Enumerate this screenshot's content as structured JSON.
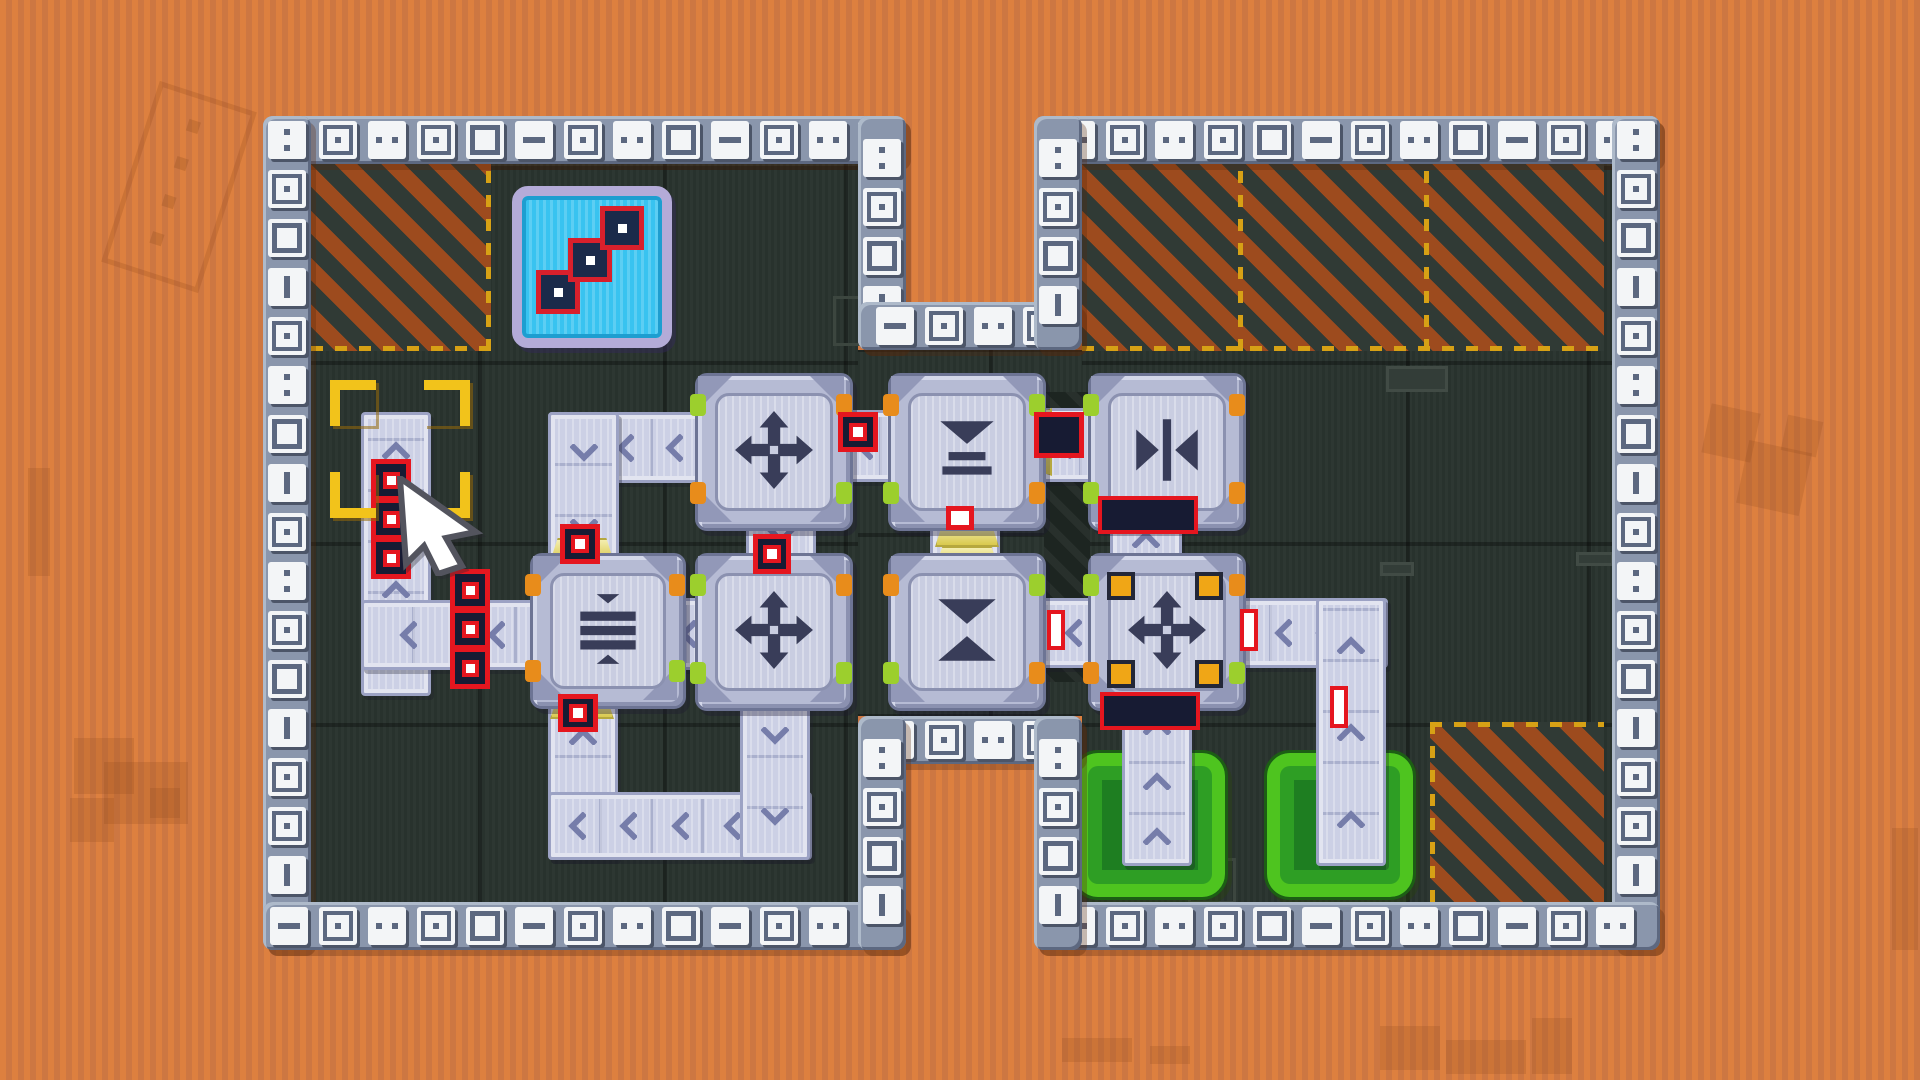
{
  "game": {
    "title": "conveyor-factory-puzzle-board",
    "colors": {
      "background_orange": "#dc7e3d",
      "floor_dark": "#28322d",
      "wall_band": "#8a96ac",
      "wall_tile": "#f3f5f7",
      "hazard_orange": "#9d4b1e",
      "hazard_dark": "#303a35",
      "hazard_dash_yellow": "#d7a115",
      "belt_lavender": "#ccd0e5",
      "machine_lavender": "#b6bbd4",
      "icon_navy": "#393d59",
      "item_red": "#e5161f",
      "item_navy": "#171b33",
      "goal_green_bright": "#4ec41f",
      "goal_green_dark": "#1e7e21",
      "sign_cyan": "#38c3f0",
      "sign_frame": "#b4abd8",
      "selection_yellow": "#f2c31b",
      "nub_green": "#9ccf2d",
      "nub_orange": "#e88c1b"
    },
    "scene": {
      "watermarks": [
        {
          "kind": "ruler-outline",
          "x": 128,
          "y": 92,
          "w": 92,
          "h": 180,
          "rot": 18
        },
        {
          "kind": "square",
          "x": 74,
          "y": 738,
          "w": 60,
          "h": 56,
          "rot": 0
        },
        {
          "kind": "square",
          "x": 104,
          "y": 762,
          "w": 84,
          "h": 62,
          "rot": 0
        },
        {
          "kind": "square",
          "x": 70,
          "y": 798,
          "w": 44,
          "h": 44,
          "rot": 0
        },
        {
          "kind": "square",
          "x": 150,
          "y": 788,
          "w": 30,
          "h": 30,
          "rot": 0
        },
        {
          "kind": "bar",
          "x": 28,
          "y": 468,
          "w": 22,
          "h": 108,
          "rot": 0
        },
        {
          "kind": "square",
          "x": 1706,
          "y": 408,
          "w": 50,
          "h": 50,
          "rot": 12
        },
        {
          "kind": "square",
          "x": 1742,
          "y": 446,
          "w": 64,
          "h": 64,
          "rot": 12
        },
        {
          "kind": "square",
          "x": 1784,
          "y": 418,
          "w": 36,
          "h": 36,
          "rot": 12
        },
        {
          "kind": "bar",
          "x": 1892,
          "y": 828,
          "w": 26,
          "h": 122,
          "rot": 0
        },
        {
          "kind": "square",
          "x": 1062,
          "y": 1038,
          "w": 70,
          "h": 24,
          "rot": 0
        },
        {
          "kind": "square",
          "x": 1150,
          "y": 1046,
          "w": 40,
          "h": 18,
          "rot": 0
        },
        {
          "kind": "square",
          "x": 1380,
          "y": 1026,
          "w": 60,
          "h": 44,
          "rot": 0
        },
        {
          "kind": "square",
          "x": 1446,
          "y": 1040,
          "w": 80,
          "h": 34,
          "rot": 0
        },
        {
          "kind": "square",
          "x": 1532,
          "y": 1018,
          "w": 40,
          "h": 56,
          "rot": 0
        }
      ],
      "floors": [
        {
          "x": 311,
          "y": 164,
          "w": 547,
          "h": 738,
          "grid_phase_x": 175,
          "grid_phase_y": 183
        },
        {
          "x": 1082,
          "y": 164,
          "w": 530,
          "h": 738,
          "grid_phase_x": 147,
          "grid_phase_y": 183
        },
        {
          "x": 858,
          "y": 350,
          "w": 224,
          "h": 366,
          "grid_phase_x": 178,
          "grid_phase_y": 179
        }
      ],
      "hazards": [
        {
          "x": 311,
          "y": 164,
          "w": 180,
          "h": 187,
          "dash": [
            "right",
            "bottom"
          ]
        },
        {
          "x": 1082,
          "y": 164,
          "w": 522,
          "h": 187,
          "dash": [
            "bottom"
          ]
        },
        {
          "x": 1430,
          "y": 722,
          "w": 174,
          "h": 180,
          "dash": [
            "top",
            "left"
          ]
        }
      ],
      "hazard_separators": [
        {
          "x": 1238,
          "y": 164,
          "h": 187
        },
        {
          "x": 1424,
          "y": 164,
          "h": 187
        }
      ],
      "floor_marks": [
        {
          "type": "slot",
          "x": 1386,
          "y": 366,
          "w": 62,
          "h": 26
        },
        {
          "type": "slot",
          "x": 1380,
          "y": 562,
          "w": 34,
          "h": 14
        },
        {
          "type": "slot",
          "x": 1576,
          "y": 552,
          "w": 38,
          "h": 14
        },
        {
          "type": "outline",
          "x": 833,
          "y": 296,
          "w": 44,
          "h": 44
        },
        {
          "type": "outline",
          "x": 1188,
          "y": 858,
          "w": 42,
          "h": 40
        }
      ],
      "duct": {
        "x": 1044,
        "y": 392,
        "w": 46,
        "h": 290
      },
      "walls": [
        {
          "x": 263,
          "y": 116,
          "len": 643,
          "dir": "h"
        },
        {
          "x": 263,
          "y": 116,
          "len": 834,
          "dir": "v"
        },
        {
          "x": 263,
          "y": 902,
          "len": 643,
          "dir": "h"
        },
        {
          "x": 858,
          "y": 116,
          "len": 234,
          "dir": "v"
        },
        {
          "x": 858,
          "y": 302,
          "len": 224,
          "dir": "h"
        },
        {
          "x": 858,
          "y": 716,
          "len": 224,
          "dir": "h"
        },
        {
          "x": 858,
          "y": 716,
          "len": 234,
          "dir": "v"
        },
        {
          "x": 1034,
          "y": 116,
          "len": 626,
          "dir": "h"
        },
        {
          "x": 1612,
          "y": 116,
          "len": 834,
          "dir": "v"
        },
        {
          "x": 1034,
          "y": 902,
          "len": 626,
          "dir": "h"
        },
        {
          "x": 1034,
          "y": 116,
          "len": 234,
          "dir": "v"
        },
        {
          "x": 1034,
          "y": 716,
          "len": 234,
          "dir": "v"
        }
      ],
      "wall_glyph_cycle": [
        "corner",
        "dash",
        "boxdot",
        "dots",
        "boxdot",
        "box",
        "dash",
        "boxdot",
        "dots",
        "box",
        "dash",
        "boxdot",
        "dots",
        "boxdot",
        "box",
        "dash",
        "boxdot"
      ],
      "goal_pads": [
        {
          "x": 1072,
          "y": 750,
          "w": 150,
          "h": 144
        },
        {
          "x": 1264,
          "y": 750,
          "w": 146,
          "h": 144
        }
      ],
      "sign": {
        "x": 512,
        "y": 186,
        "w": 140,
        "h": 142,
        "items": [
          {
            "dx": 14,
            "dy": 74
          },
          {
            "dx": 46,
            "dy": 42
          },
          {
            "dx": 78,
            "dy": 10
          }
        ]
      },
      "belts": [
        {
          "x": 361,
          "y": 412,
          "w": 64,
          "h": 278,
          "dir": "up",
          "chev": 4
        },
        {
          "x": 361,
          "y": 600,
          "w": 176,
          "h": 64,
          "dir": "left",
          "chev": 2
        },
        {
          "x": 548,
          "y": 412,
          "w": 148,
          "h": 65,
          "dir": "left",
          "chev": 3
        },
        {
          "x": 548,
          "y": 412,
          "w": 65,
          "h": 150,
          "dir": "down",
          "chev": 2
        },
        {
          "x": 746,
          "y": 503,
          "w": 64,
          "h": 60,
          "dir": "down",
          "chev": 1
        },
        {
          "x": 635,
          "y": 598,
          "w": 66,
          "h": 66,
          "dir": "left",
          "chev": 2
        },
        {
          "x": 548,
          "y": 692,
          "w": 64,
          "h": 162,
          "dir": "up",
          "chev": 2
        },
        {
          "x": 548,
          "y": 792,
          "w": 258,
          "h": 62,
          "dir": "left",
          "chev": 5
        },
        {
          "x": 740,
          "y": 692,
          "w": 64,
          "h": 162,
          "dir": "down",
          "chev": 2
        },
        {
          "x": 828,
          "y": 410,
          "w": 66,
          "h": 66,
          "dir": "left",
          "chev": 1
        },
        {
          "x": 930,
          "y": 504,
          "w": 64,
          "h": 62,
          "dir": "up",
          "chev": 1
        },
        {
          "x": 1028,
          "y": 408,
          "w": 66,
          "h": 68,
          "dir": "left",
          "chev": 1
        },
        {
          "x": 1110,
          "y": 504,
          "w": 66,
          "h": 64,
          "dir": "up",
          "chev": 1
        },
        {
          "x": 1038,
          "y": 598,
          "w": 64,
          "h": 64,
          "dir": "left",
          "chev": 1
        },
        {
          "x": 1218,
          "y": 598,
          "w": 164,
          "h": 64,
          "dir": "left",
          "chev": 4
        },
        {
          "x": 1316,
          "y": 598,
          "w": 64,
          "h": 262,
          "dir": "up",
          "chev": 3
        },
        {
          "x": 1122,
          "y": 696,
          "w": 64,
          "h": 164,
          "dir": "up",
          "chev": 3
        }
      ],
      "funnels": [
        {
          "x": 550,
          "y": 538,
          "w": 60,
          "h": 20,
          "shape": "v"
        },
        {
          "x": 550,
          "y": 697,
          "w": 60,
          "h": 18,
          "shape": "v"
        },
        {
          "x": 935,
          "y": 523,
          "w": 60,
          "h": 20,
          "shape": "v"
        },
        {
          "x": 1030,
          "y": 408,
          "w": 18,
          "h": 64,
          "shape": "h"
        },
        {
          "x": 935,
          "y": 546,
          "w": 60,
          "h": 18,
          "shape": "v"
        }
      ],
      "machines": [
        {
          "x": 695,
          "y": 373,
          "size": 152,
          "icon": "move-arrows",
          "nubs": [
            "green",
            "orange",
            "orange",
            "green"
          ],
          "squares": false
        },
        {
          "x": 888,
          "y": 373,
          "size": 152,
          "icon": "press-down",
          "nubs": [
            "orange",
            "green",
            "green",
            "orange"
          ],
          "squares": false
        },
        {
          "x": 1088,
          "y": 373,
          "size": 152,
          "icon": "squeeze-horizontal",
          "nubs": [
            "green",
            "orange",
            "green",
            "orange"
          ],
          "squares": false
        },
        {
          "x": 530,
          "y": 553,
          "size": 150,
          "icon": "press-stack",
          "nubs": [
            "orange",
            "orange",
            "orange",
            "green"
          ],
          "squares": false
        },
        {
          "x": 695,
          "y": 553,
          "size": 152,
          "icon": "move-arrows",
          "nubs": [
            "green",
            "orange",
            "green",
            "green"
          ],
          "squares": false
        },
        {
          "x": 888,
          "y": 553,
          "size": 152,
          "icon": "squeeze-vertical",
          "nubs": [
            "orange",
            "green",
            "green",
            "orange"
          ],
          "squares": false
        },
        {
          "x": 1088,
          "y": 553,
          "size": 152,
          "icon": "move-arrows",
          "nubs": [
            "green",
            "orange",
            "orange",
            "green"
          ],
          "squares": true
        }
      ],
      "items": [
        {
          "type": "stack3",
          "x": 371,
          "y": 462
        },
        {
          "type": "stack3",
          "x": 450,
          "y": 572
        },
        {
          "type": "box",
          "x": 560,
          "y": 524,
          "w": 40,
          "h": 40
        },
        {
          "type": "box",
          "x": 838,
          "y": 412,
          "w": 40,
          "h": 40
        },
        {
          "type": "box",
          "x": 558,
          "y": 694,
          "w": 40,
          "h": 38
        },
        {
          "type": "box",
          "x": 753,
          "y": 534,
          "w": 38,
          "h": 40
        },
        {
          "type": "small",
          "x": 946,
          "y": 506,
          "w": 28,
          "h": 24
        },
        {
          "type": "bigdark",
          "x": 1034,
          "y": 412,
          "w": 50,
          "h": 46
        },
        {
          "type": "bar",
          "x": 1098,
          "y": 496,
          "w": 100,
          "h": 38
        },
        {
          "type": "bar",
          "x": 1100,
          "y": 692,
          "w": 100,
          "h": 38
        },
        {
          "type": "thin",
          "x": 1047,
          "y": 610,
          "w": 18,
          "h": 40
        },
        {
          "type": "thin",
          "x": 1240,
          "y": 609,
          "w": 18,
          "h": 42
        },
        {
          "type": "thin",
          "x": 1330,
          "y": 686,
          "w": 18,
          "h": 42
        }
      ],
      "selection": {
        "x": 330,
        "y": 380,
        "w": 130,
        "h": 128
      },
      "cursor": {
        "x": 396,
        "y": 476,
        "w": 90,
        "h": 100
      }
    }
  }
}
